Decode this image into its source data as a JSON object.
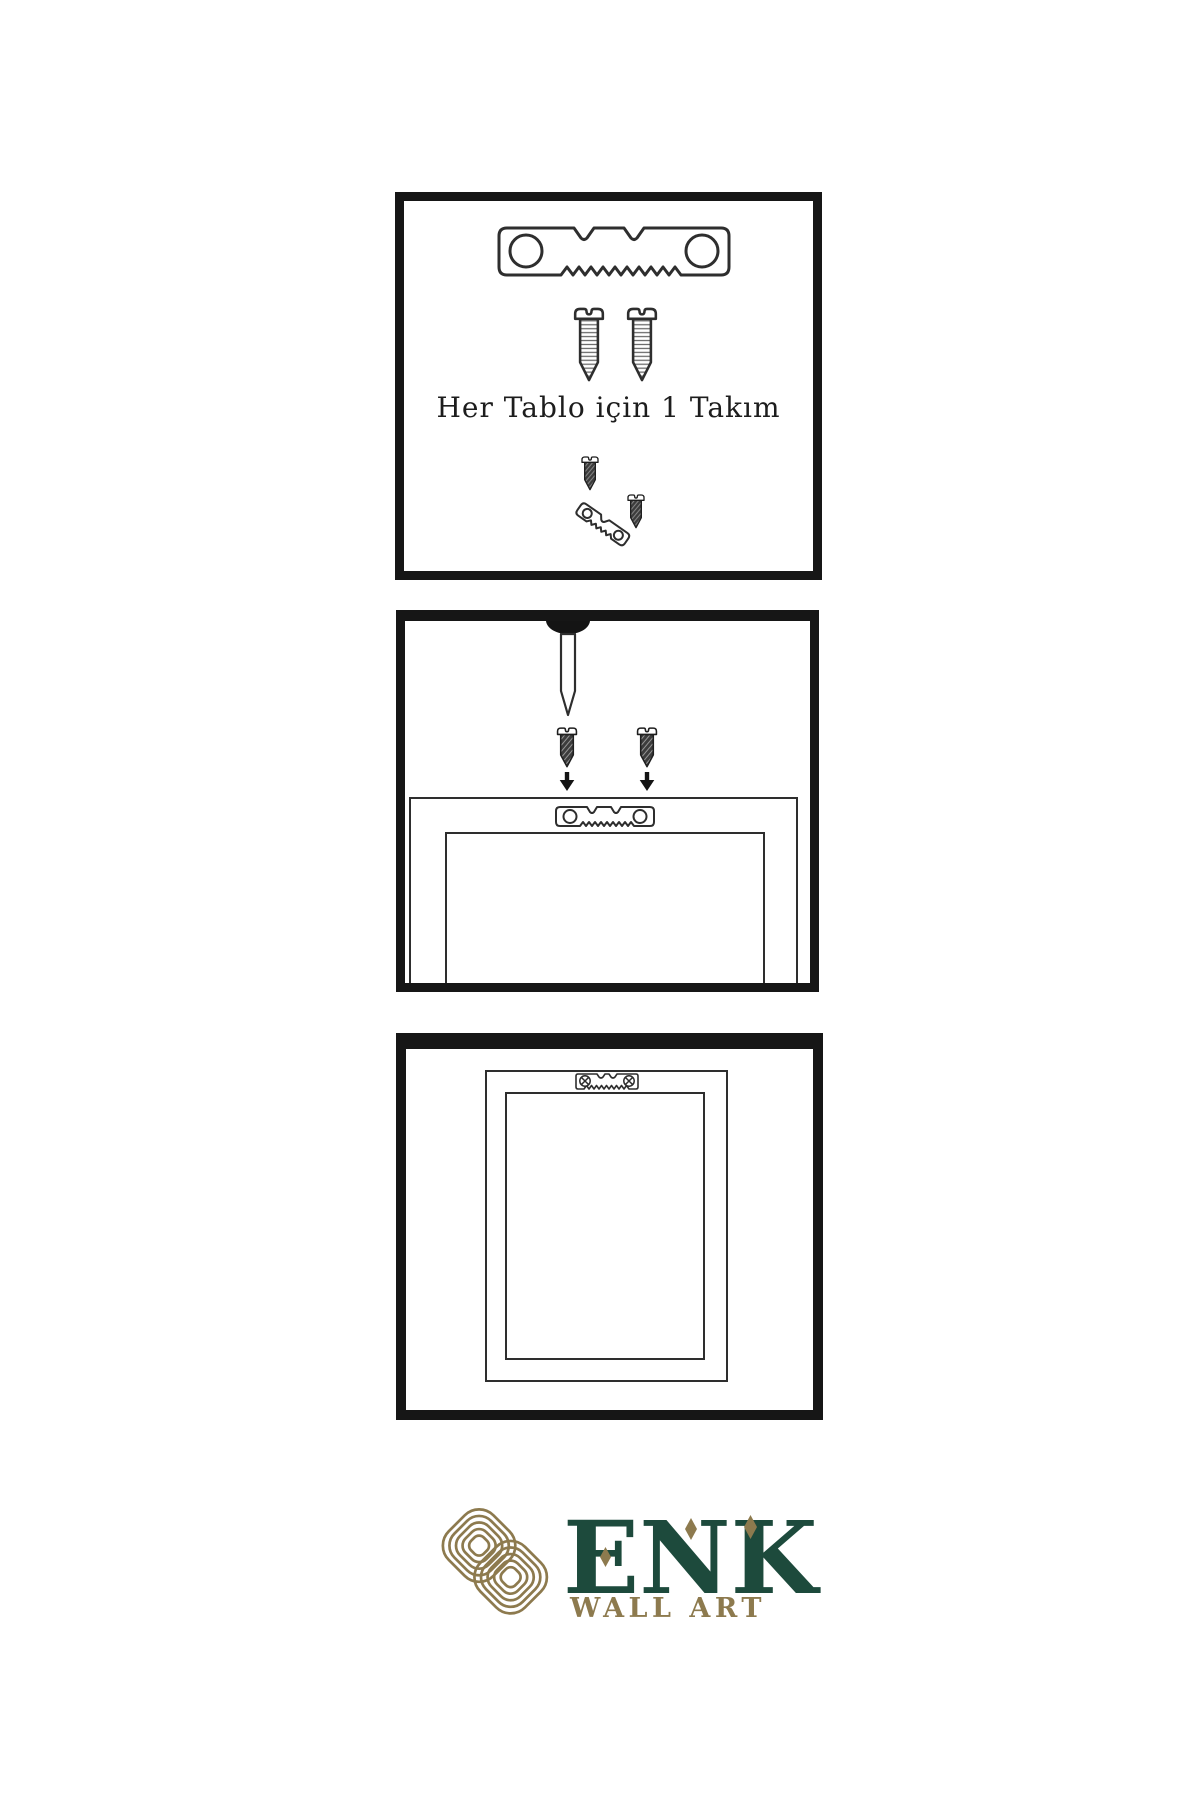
{
  "colors": {
    "page_bg": "#ffffff",
    "line": "#2e2e2e",
    "panel_border": "#161616",
    "dark_fill": "#3c3c3c",
    "gold": "#8d7a4e",
    "green": "#1d4a3c",
    "text": "#1d1d1d"
  },
  "panels": [
    {
      "name": "hardware-kit-panel",
      "caption": "Her Tablo için 1 Takım",
      "icons": [
        "sawtooth-hanger-icon",
        "two-screws-icon",
        "screw-into-hanger-icon"
      ]
    },
    {
      "name": "wall-mounting-panel",
      "icons": [
        "nail-icon",
        "screw-down-arrow-left-icon",
        "screw-down-arrow-right-icon",
        "frame-back-outline",
        "sawtooth-hanger-small-icon"
      ]
    },
    {
      "name": "hung-frame-panel",
      "icons": [
        "frame-outer-outline",
        "frame-inner-outline",
        "mounted-hanger-icon"
      ]
    }
  ],
  "logo": {
    "icon": "knot-logo-icon",
    "brand": "ENK",
    "subtitle": "WALL ART",
    "accents": [
      "diamond-accent-1",
      "diamond-accent-2",
      "diamond-accent-3"
    ]
  }
}
